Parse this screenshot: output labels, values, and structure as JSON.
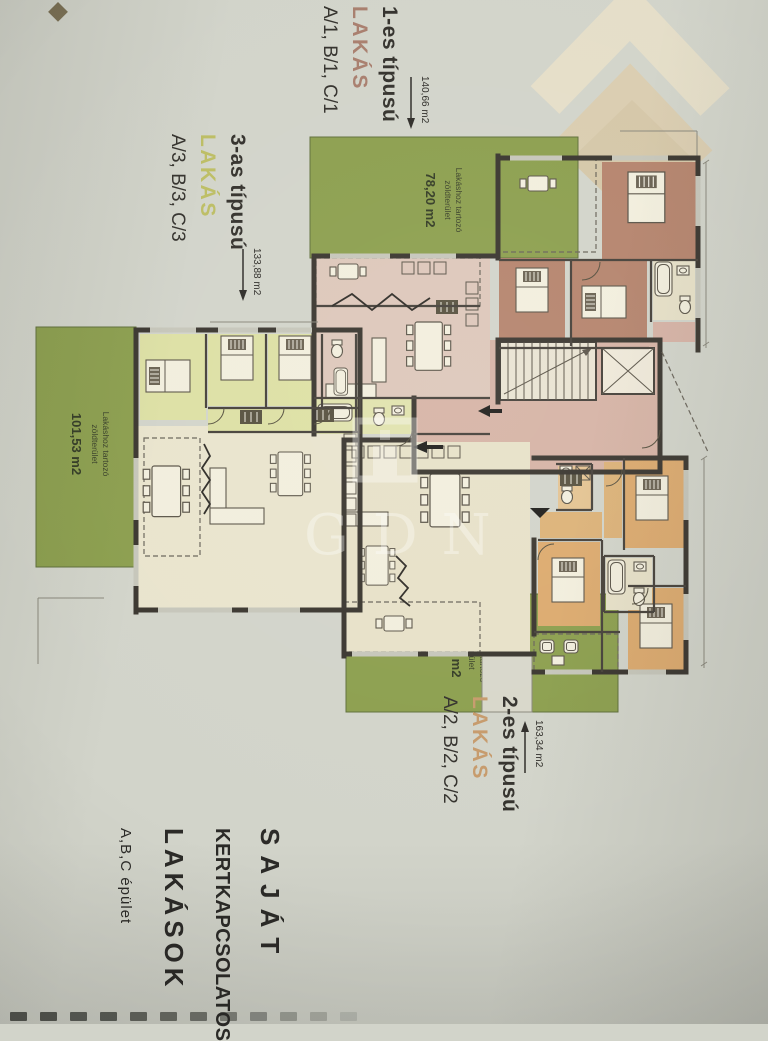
{
  "watermark": {
    "text": "GDN"
  },
  "title_block": {
    "line1": "SAJÁT",
    "line2": "KERTKAPCSOLATOS",
    "line3": "LAKÁSOK",
    "subtitle": "A,B,C épület"
  },
  "apartments": [
    {
      "type_label": "1-es típusú",
      "word": "LAKÁS",
      "units": "A/1, B/1, C/1",
      "area": "140,66 m2",
      "accent": "#a87e6d"
    },
    {
      "type_label": "3-as típusú",
      "word": "LAKÁS",
      "units": "A/3, B/3, C/3",
      "area": "133,88 m2",
      "accent": "#bcbd63"
    },
    {
      "type_label": "2-es típusú",
      "word": "LAKÁS",
      "units": "A/2, B/2, C/2",
      "area": "163,34 m2",
      "accent": "#c69a6b"
    }
  ],
  "green_areas": [
    {
      "line1": "Lakáshoz tartozó",
      "line2": "zöldterület",
      "area": "78,20 m2"
    },
    {
      "line1": "Lakáshoz tartozó",
      "line2": "zöldterület",
      "area": "101,53 m2"
    },
    {
      "line1": "Lakáshoz tartozó",
      "line2": "zöldterület",
      "area": "78,20 m2"
    }
  ],
  "colors": {
    "paper": "#d2d4ca",
    "green": "#8c9f4e",
    "olive_room": "#dde0a4",
    "pale_olive": "#e0e2ad",
    "cream_room": "#e7e1c8",
    "pink_room": "#ddc7ba",
    "pink_common": "#d6b3a5",
    "brown_room": "#b5846d",
    "mauve_terrace": "#d2b8a8",
    "orange_room": "#dcaa6e",
    "orange_light": "#e4c392",
    "orange_hall": "#dcb278",
    "wall": "#3a362f"
  }
}
